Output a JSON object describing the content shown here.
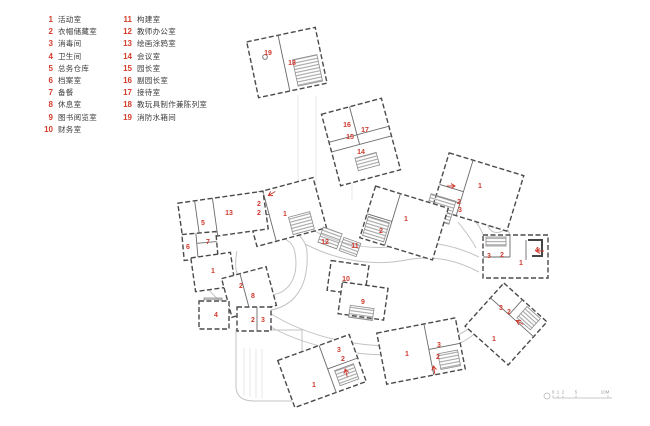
{
  "colors": {
    "accent": "#cf3a2e",
    "wall": "#4a4a4a",
    "corridor": "#c3c3c3",
    "text": "#3c3c3c"
  },
  "legend": {
    "items": [
      {
        "num": "1",
        "label": "活动室"
      },
      {
        "num": "2",
        "label": "衣帽储藏室"
      },
      {
        "num": "3",
        "label": "消毒间"
      },
      {
        "num": "4",
        "label": "卫生间"
      },
      {
        "num": "5",
        "label": "总务仓库"
      },
      {
        "num": "6",
        "label": "档案室"
      },
      {
        "num": "7",
        "label": "备餐"
      },
      {
        "num": "8",
        "label": "休息室"
      },
      {
        "num": "9",
        "label": "图书阅览室"
      },
      {
        "num": "10",
        "label": "财务室"
      },
      {
        "num": "11",
        "label": "构建室"
      },
      {
        "num": "12",
        "label": "教师办公室"
      },
      {
        "num": "13",
        "label": "绘画涂鸦室"
      },
      {
        "num": "14",
        "label": "会议室"
      },
      {
        "num": "15",
        "label": "园长室"
      },
      {
        "num": "16",
        "label": "副园长室"
      },
      {
        "num": "17",
        "label": "接待室"
      },
      {
        "num": "18",
        "label": "教玩具制作兼陈列室"
      },
      {
        "num": "19",
        "label": "消防水箱间"
      }
    ]
  },
  "plan": {
    "room_labels": [
      {
        "t": "19",
        "x": 268,
        "y": 55
      },
      {
        "t": "18",
        "x": 292,
        "y": 65
      },
      {
        "t": "16",
        "x": 347,
        "y": 127
      },
      {
        "t": "17",
        "x": 365,
        "y": 132
      },
      {
        "t": "15",
        "x": 350,
        "y": 139
      },
      {
        "t": "14",
        "x": 361,
        "y": 154
      },
      {
        "t": "13",
        "x": 229,
        "y": 215
      },
      {
        "t": "5",
        "x": 203,
        "y": 225
      },
      {
        "t": "2",
        "x": 259,
        "y": 206
      },
      {
        "t": "2",
        "x": 259,
        "y": 215
      },
      {
        "t": "1",
        "x": 285,
        "y": 216
      },
      {
        "t": "6",
        "x": 188,
        "y": 249
      },
      {
        "t": "7",
        "x": 208,
        "y": 244
      },
      {
        "t": "1",
        "x": 213,
        "y": 273
      },
      {
        "t": "2",
        "x": 241,
        "y": 288
      },
      {
        "t": "8",
        "x": 253,
        "y": 298
      },
      {
        "t": "12",
        "x": 325,
        "y": 244
      },
      {
        "t": "11",
        "x": 355,
        "y": 248
      },
      {
        "t": "2",
        "x": 381,
        "y": 233
      },
      {
        "t": "1",
        "x": 406,
        "y": 221
      },
      {
        "t": "1",
        "x": 480,
        "y": 188
      },
      {
        "t": "2",
        "x": 459,
        "y": 204
      },
      {
        "t": "3",
        "x": 460,
        "y": 212
      },
      {
        "t": "10",
        "x": 346,
        "y": 281
      },
      {
        "t": "9",
        "x": 363,
        "y": 304
      },
      {
        "t": "4",
        "x": 216,
        "y": 317
      },
      {
        "t": "2",
        "x": 253,
        "y": 322
      },
      {
        "t": "3",
        "x": 263,
        "y": 322
      },
      {
        "t": "3",
        "x": 489,
        "y": 258
      },
      {
        "t": "2",
        "x": 502,
        "y": 257
      },
      {
        "t": "1",
        "x": 521,
        "y": 265
      },
      {
        "t": "4",
        "x": 537,
        "y": 252
      },
      {
        "t": "3",
        "x": 501,
        "y": 310
      },
      {
        "t": "2",
        "x": 509,
        "y": 314
      },
      {
        "t": "1",
        "x": 494,
        "y": 341
      },
      {
        "t": "3",
        "x": 439,
        "y": 347
      },
      {
        "t": "2",
        "x": 438,
        "y": 359
      },
      {
        "t": "1",
        "x": 407,
        "y": 356
      },
      {
        "t": "3",
        "x": 339,
        "y": 352
      },
      {
        "t": "2",
        "x": 343,
        "y": 361
      },
      {
        "t": "1",
        "x": 314,
        "y": 387
      }
    ],
    "arrows": [
      {
        "x": 271,
        "y": 194,
        "a": 150
      },
      {
        "x": 452,
        "y": 186,
        "a": 0
      },
      {
        "x": 539,
        "y": 251,
        "a": 180
      },
      {
        "x": 519,
        "y": 322,
        "a": 210
      },
      {
        "x": 434,
        "y": 369,
        "a": 260
      },
      {
        "x": 346,
        "y": 372,
        "a": 255
      }
    ]
  },
  "scalebar": {
    "labels": [
      {
        "t": "0",
        "x": 553
      },
      {
        "t": "1",
        "x": 558
      },
      {
        "t": "2",
        "x": 563
      },
      {
        "t": "5",
        "x": 576
      },
      {
        "t": "10M",
        "x": 605
      }
    ]
  }
}
